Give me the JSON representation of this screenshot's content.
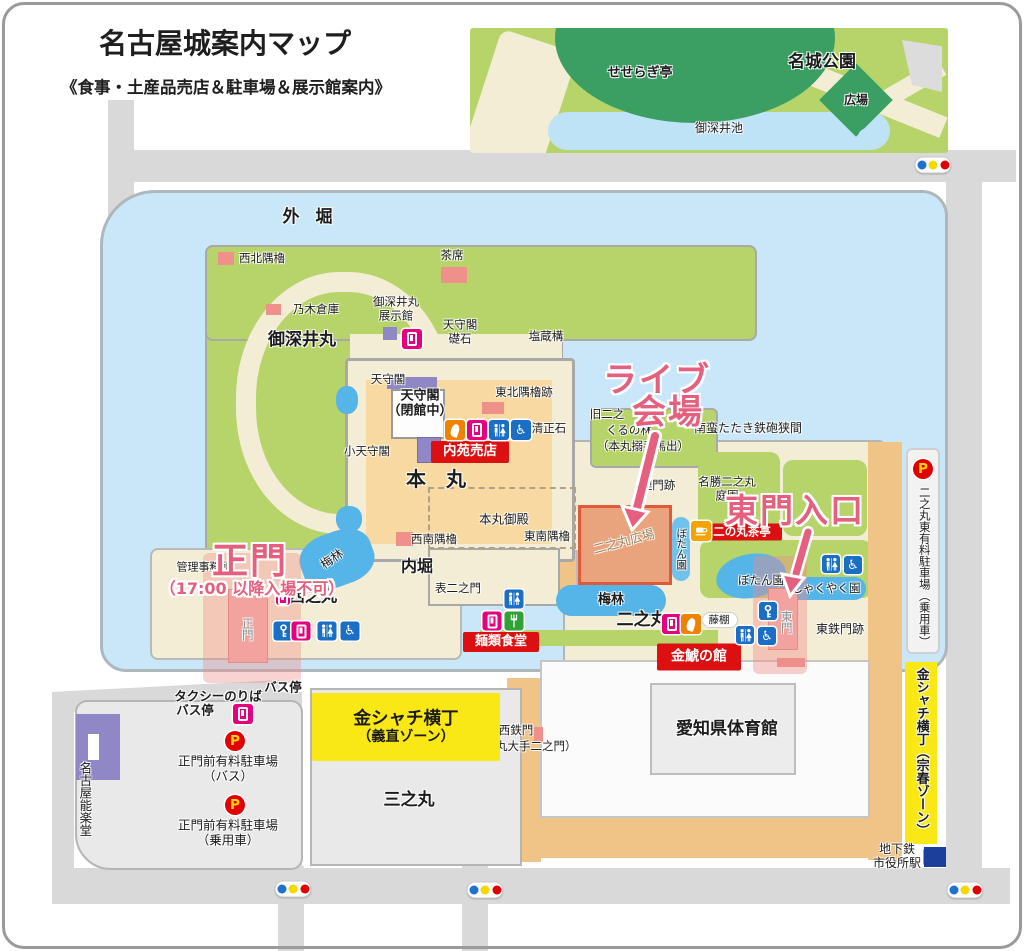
{
  "header": {
    "title": "名古屋城案内マップ",
    "subtitle": "《食事・土産品売店＆駐車場＆展示館案内》"
  },
  "annotations": {
    "live_line1": "ライブ",
    "live_line2": "会場",
    "east_gate": "東門入口",
    "main_gate": "正門",
    "main_gate_note": "（17:00 以降入場不可）"
  },
  "colors": {
    "annotation_pink": "#e5607e",
    "label_red_box": "#dc1010",
    "kinshachi_yellow": "#f9e816",
    "moat_blue": "#c9e7f8",
    "park_green": "#b6d46a",
    "dark_green": "#3b9e63",
    "plaza_orange": "#e9a37d",
    "road_gray": "#d9d9d9",
    "water_blue": "#55b4e8",
    "purple_building": "#8f87c6",
    "pink_building": "#f0908a"
  },
  "labels": [
    {
      "name": "outer-moat-label",
      "text": "外 堀",
      "x": 310,
      "y": 217,
      "s": 17,
      "b": 1,
      "ls": 5
    },
    {
      "name": "meijo-park-label",
      "text": "名城公園",
      "x": 822,
      "y": 62,
      "s": 17,
      "b": 1
    },
    {
      "name": "seseragi-tei-label",
      "text": "せせらぎ亭",
      "x": 640,
      "y": 73,
      "s": 13,
      "b": 1
    },
    {
      "name": "hiroba-label",
      "text": "広場",
      "x": 856,
      "y": 100,
      "s": 12,
      "b": 1
    },
    {
      "name": "ofukei-pond-label",
      "text": "御深井池",
      "x": 719,
      "y": 128,
      "s": 12
    },
    {
      "name": "seihoku-sumiyagura-label",
      "text": "西北隅櫓",
      "x": 262,
      "y": 259,
      "s": 11.5
    },
    {
      "name": "chaseki-label",
      "text": "茶席",
      "x": 452,
      "y": 256,
      "s": 11.5
    },
    {
      "name": "nogi-soko-label",
      "text": "乃木倉庫",
      "x": 316,
      "y": 310,
      "s": 11.5
    },
    {
      "name": "ofukemaru-label",
      "text": "御深井丸",
      "x": 302,
      "y": 340,
      "s": 17,
      "b": 1
    },
    {
      "name": "ofukemaru-tenjikan-label",
      "text": "御深井丸\n展示館",
      "x": 396,
      "y": 309,
      "s": 11.5
    },
    {
      "name": "tenshukaku-soseki-label",
      "text": "天守閣\n礎石",
      "x": 460,
      "y": 332,
      "s": 11.5
    },
    {
      "name": "enzogamae-label",
      "text": "塩蔵構",
      "x": 546,
      "y": 337,
      "s": 11.5
    },
    {
      "name": "tenshukaku-small-label",
      "text": "天守閣",
      "x": 388,
      "y": 380,
      "s": 11.5
    },
    {
      "name": "tenshukaku-closed-label",
      "text": "天守閣\n（閉館中）",
      "x": 420,
      "y": 404,
      "s": 13,
      "b": 1
    },
    {
      "name": "tohoku-sumiyagura-ato-label",
      "text": "東北隅櫓跡",
      "x": 524,
      "y": 393,
      "s": 11.5
    },
    {
      "name": "kiyomasa-ishi-label",
      "text": "清正石",
      "x": 549,
      "y": 429,
      "s": 11.5
    },
    {
      "name": "kotenshukaku-label",
      "text": "小天守閣",
      "x": 367,
      "y": 452,
      "s": 11.5
    },
    {
      "name": "honmaru-label",
      "text": "本　丸",
      "x": 436,
      "y": 480,
      "s": 20,
      "b": 1
    },
    {
      "name": "honmaru-goten-label",
      "text": "本丸御殿",
      "x": 504,
      "y": 520,
      "s": 12.5
    },
    {
      "name": "seinan-sumiyagura-label",
      "text": "西南隅櫓",
      "x": 434,
      "y": 540,
      "s": 11.5
    },
    {
      "name": "tonan-sumiyagura-label",
      "text": "東南隅櫓",
      "x": 547,
      "y": 537,
      "s": 11.5
    },
    {
      "name": "uchibori-label",
      "text": "内堀",
      "x": 417,
      "y": 567,
      "s": 16,
      "b": 1
    },
    {
      "name": "kyu-ninomaru-label",
      "text": "旧二之",
      "x": 607,
      "y": 415,
      "s": 11.5
    },
    {
      "name": "kuruno-hayashi-label",
      "text": "くるの林",
      "x": 629,
      "y": 431,
      "s": 11.5
    },
    {
      "name": "karamete-umadashi-label",
      "text": "（本丸搦手馬出）",
      "x": 643,
      "y": 447,
      "s": 11.5
    },
    {
      "name": "nanban-tataki-label",
      "text": "南蛮たたき鉄砲狭間",
      "x": 748,
      "y": 428,
      "s": 12
    },
    {
      "name": "uzumimon-ato-label",
      "text": "埋門跡",
      "x": 658,
      "y": 486,
      "s": 11.5
    },
    {
      "name": "meisho-ninomaru-teien-label",
      "text": "名勝二之丸\n庭園",
      "x": 727,
      "y": 489,
      "s": 11.5
    },
    {
      "name": "ninomaru-hiroba-label",
      "text": "二之丸広場",
      "x": 624,
      "y": 542,
      "s": 12.5,
      "r": -15,
      "c": "#9c7f58"
    },
    {
      "name": "botan-en-vertical-label",
      "text": "ぼたん園",
      "x": 681,
      "y": 549,
      "s": 10.5,
      "v": 1
    },
    {
      "name": "botan-en-label",
      "text": "ぼたん園",
      "x": 761,
      "y": 581,
      "s": 11.5
    },
    {
      "name": "shakuyaku-en-label",
      "text": "しゃくやく園",
      "x": 826,
      "y": 589,
      "s": 11.5
    },
    {
      "name": "bairin-west-label",
      "text": "梅林",
      "x": 332,
      "y": 559,
      "s": 12,
      "r": -35
    },
    {
      "name": "bairin-east-label",
      "text": "梅林",
      "x": 611,
      "y": 600,
      "s": 13,
      "b": 1
    },
    {
      "name": "kanri-jimusho-label",
      "text": "管理事務所",
      "x": 204,
      "y": 568,
      "s": 11
    },
    {
      "name": "nishinomaru-label",
      "text": "西之丸",
      "x": 313,
      "y": 597,
      "s": 16,
      "b": 1
    },
    {
      "name": "omote-ninomon-label",
      "text": "表二之門",
      "x": 458,
      "y": 589,
      "s": 11.5
    },
    {
      "name": "ninomaru-label",
      "text": "二之丸",
      "x": 642,
      "y": 620,
      "s": 17,
      "b": 1
    },
    {
      "name": "fujidana-label",
      "text": "藤棚",
      "x": 719,
      "y": 620,
      "s": 10.5
    },
    {
      "name": "east-gate-name-label",
      "text": "東門",
      "x": 786,
      "y": 622,
      "s": 11.5,
      "v": 1,
      "c": "#8c8c8c"
    },
    {
      "name": "higashi-tetsumon-ato-label",
      "text": "東鉄門跡",
      "x": 840,
      "y": 629,
      "s": 12
    },
    {
      "name": "main-gate-name-label",
      "text": "正門",
      "x": 247,
      "y": 629,
      "s": 11.5,
      "v": 1,
      "c": "#8c8c8c"
    },
    {
      "name": "taxi-noriba-label",
      "text": "タクシーのりば",
      "x": 218,
      "y": 697,
      "s": 12.5,
      "b": 1
    },
    {
      "name": "bus-stop-1-label",
      "text": "バス停",
      "x": 195,
      "y": 711,
      "s": 12.5,
      "b": 1
    },
    {
      "name": "bus-stop-2-label",
      "text": "バス停",
      "x": 283,
      "y": 688,
      "s": 12.5,
      "b": 1
    },
    {
      "name": "seimon-parking-bus-label",
      "text": "正門前有料駐車場\n（バス）",
      "x": 228,
      "y": 769,
      "s": 12.5
    },
    {
      "name": "seimon-parking-car-label",
      "text": "正門前有料駐車場\n（乗用車）",
      "x": 228,
      "y": 833,
      "s": 12.5
    },
    {
      "name": "nagoya-nohgakudo-label",
      "text": "名古屋能楽堂",
      "x": 84,
      "y": 799,
      "s": 12.5,
      "v": 1
    },
    {
      "name": "sannomaru-label",
      "text": "三之丸",
      "x": 409,
      "y": 800,
      "s": 17,
      "b": 1
    },
    {
      "name": "nishi-tetsumon-label",
      "text": "西鉄門",
      "x": 516,
      "y": 731,
      "s": 11.5
    },
    {
      "name": "ninomaru-ote-ninomon-label",
      "text": "（二之丸大手二之門）",
      "x": 519,
      "y": 747,
      "s": 11.5
    },
    {
      "name": "aichi-taiikukan-label",
      "text": "愛知県体育館",
      "x": 727,
      "y": 729,
      "s": 17,
      "b": 1
    },
    {
      "name": "chikatetsu-shiyakusho-label",
      "text": "地下鉄\n市役所駅",
      "x": 897,
      "y": 856,
      "s": 12
    },
    {
      "name": "ninomaru-east-parking-label",
      "text": "二之丸東有料駐車場（乗用車）",
      "x": 924,
      "y": 567,
      "s": 11.5,
      "v": 1
    },
    {
      "name": "kinshachi-muneharu-label",
      "text": "金シャチ横丁（宗春ゾーン）",
      "x": 921,
      "y": 752,
      "s": 13,
      "b": 1,
      "v": 1
    }
  ],
  "boxes": [
    {
      "name": "naien-baiten-box",
      "x": 470,
      "y": 452,
      "w": 78,
      "h": 22,
      "bg": "#dc1010",
      "fg": "#ffffff",
      "lines": [
        {
          "t": "内苑売店",
          "s": 13.5
        }
      ]
    },
    {
      "name": "menrui-shokudo-box",
      "x": 501,
      "y": 642,
      "w": 76,
      "h": 20,
      "bg": "#dc1010",
      "fg": "#ffffff",
      "lines": [
        {
          "t": "麺類食堂",
          "s": 13
        }
      ]
    },
    {
      "name": "kinko-no-yakata-box",
      "x": 699,
      "y": 657,
      "w": 84,
      "h": 27,
      "bg": "#dc1010",
      "fg": "#ffffff",
      "lines": [
        {
          "t": "金鯱の館",
          "s": 14
        }
      ]
    },
    {
      "name": "ninomaru-chatei-box",
      "x": 742,
      "y": 532,
      "w": 80,
      "h": 17,
      "bg": "#dc1010",
      "fg": "#ffffff",
      "lines": [
        {
          "t": "二の丸茶亭",
          "s": 11.5
        }
      ]
    },
    {
      "name": "kinshachi-yoshinao-box",
      "x": 406,
      "y": 727,
      "w": 188,
      "h": 68,
      "bg": "#f9e816",
      "fg": "#1a1a1a",
      "lines": [
        {
          "t": "金シャチ横丁",
          "s": 17.5
        },
        {
          "t": "（義直ゾーン）",
          "s": 14
        }
      ]
    }
  ],
  "icons": [
    {
      "name": "vending-machine-icon",
      "type": "vend",
      "x": 412,
      "y": 339,
      "s": 20
    },
    {
      "name": "vending-machine-icon",
      "type": "vend",
      "x": 283,
      "y": 598,
      "s": 14
    },
    {
      "name": "coin-locker-icon",
      "type": "key",
      "x": 283,
      "y": 631,
      "s": 19
    },
    {
      "name": "vending-machine-icon",
      "type": "vend",
      "x": 301,
      "y": 631,
      "s": 19
    },
    {
      "name": "restroom-icon",
      "type": "rest",
      "x": 327,
      "y": 631,
      "s": 19
    },
    {
      "name": "wheelchair-icon",
      "type": "wheel",
      "x": 350,
      "y": 631,
      "s": 19
    },
    {
      "name": "souvenir-shop-icon",
      "type": "shachi",
      "x": 455,
      "y": 430,
      "s": 20
    },
    {
      "name": "vending-machine-icon",
      "type": "vend",
      "x": 477,
      "y": 430,
      "s": 20
    },
    {
      "name": "restroom-icon",
      "type": "rest",
      "x": 499,
      "y": 430,
      "s": 20
    },
    {
      "name": "wheelchair-icon",
      "type": "wheel",
      "x": 521,
      "y": 430,
      "s": 20
    },
    {
      "name": "restroom-icon",
      "type": "rest",
      "x": 514,
      "y": 599,
      "s": 19
    },
    {
      "name": "vending-machine-icon",
      "type": "vend",
      "x": 492,
      "y": 621,
      "s": 19
    },
    {
      "name": "restaurant-icon",
      "type": "fork",
      "x": 514,
      "y": 621,
      "s": 19
    },
    {
      "name": "vending-machine-icon",
      "type": "vend",
      "x": 672,
      "y": 624,
      "s": 20
    },
    {
      "name": "souvenir-shop-icon",
      "type": "shachi",
      "x": 691,
      "y": 624,
      "s": 20
    },
    {
      "name": "tea-house-icon",
      "type": "tea",
      "x": 701,
      "y": 531,
      "s": 20
    },
    {
      "name": "restroom-icon",
      "type": "rest",
      "x": 745,
      "y": 635,
      "s": 18
    },
    {
      "name": "wheelchair-icon",
      "type": "wheel",
      "x": 767,
      "y": 636,
      "s": 18
    },
    {
      "name": "coin-locker-icon",
      "type": "key",
      "x": 768,
      "y": 611,
      "s": 18
    },
    {
      "name": "restroom-icon",
      "type": "rest",
      "x": 831,
      "y": 564,
      "s": 18
    },
    {
      "name": "wheelchair-icon",
      "type": "wheel",
      "x": 853,
      "y": 565,
      "s": 18
    },
    {
      "name": "vending-machine-icon",
      "type": "vend",
      "x": 243,
      "y": 714,
      "s": 20
    },
    {
      "name": "parking-icon",
      "type": "park",
      "x": 235,
      "y": 741,
      "s": 20
    },
    {
      "name": "parking-icon",
      "type": "park",
      "x": 235,
      "y": 805,
      "s": 20
    },
    {
      "name": "parking-icon",
      "type": "park",
      "x": 923,
      "y": 469,
      "s": 20
    },
    {
      "name": "traffic-light-icon",
      "type": "traffic",
      "x": 933,
      "y": 165
    },
    {
      "name": "traffic-light-icon",
      "type": "traffic",
      "x": 293,
      "y": 889
    },
    {
      "name": "traffic-light-icon",
      "type": "traffic",
      "x": 485,
      "y": 890
    },
    {
      "name": "traffic-light-icon",
      "type": "traffic",
      "x": 965,
      "y": 890
    },
    {
      "name": "subway-station-icon",
      "type": "subway",
      "x": 934,
      "y": 857,
      "s": 21
    }
  ]
}
